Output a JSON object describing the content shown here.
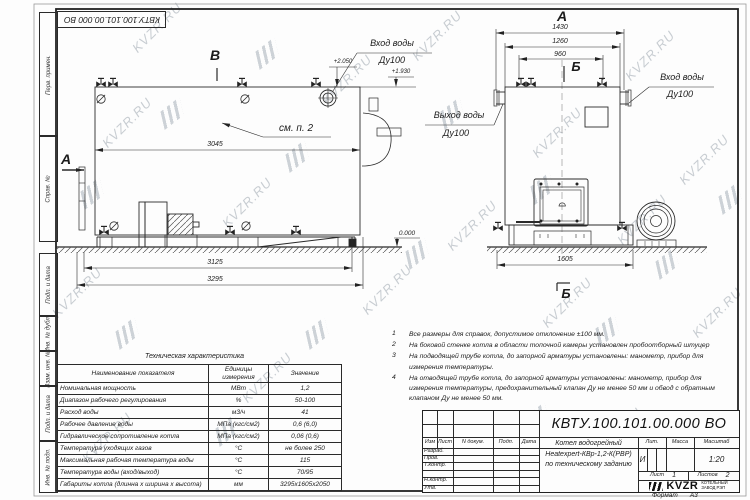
{
  "watermark": {
    "text": "KVZR.RU"
  },
  "stamp_top": "КВТУ.100.101.00.000 ВО",
  "margin": {
    "labels": [
      "Перв. примен.",
      "Справ. №",
      "Подп. и дата",
      "Инв. № дубл.",
      "Взам. инв. №",
      "Подп. и дата",
      "Инв. № подл."
    ]
  },
  "drawing": {
    "view_side": {
      "label": "В",
      "section": "А",
      "callout": "см. п. 2",
      "dim_body": "3045",
      "dim_frame": "3125",
      "dim_total": "3295",
      "level_top": "+2.050",
      "level_pipe": "+1.930",
      "inlet_l1": "Вход воды",
      "inlet_l2": "Ду100"
    },
    "view_front": {
      "label": "А",
      "section_top": "Б",
      "section_bottom": "Б",
      "dim_flanges": "1430",
      "dim_body": "1260",
      "dim_valves": "960",
      "dim_base": "1605",
      "level_zero": "0.000",
      "outlet_l1": "Выход воды",
      "outlet_l2": "Ду100",
      "inlet_l1": "Вход воды",
      "inlet_l2": "Ду100"
    }
  },
  "tech_table": {
    "title": "Техническая характеристика",
    "headers": {
      "name": "Наименование показателя",
      "unit": "Единицы измерения",
      "value": "Значение"
    },
    "rows": [
      {
        "name": "Номинальная мощность",
        "unit": "МВт",
        "value": "1,2"
      },
      {
        "name": "Диапазон рабочего регулирования",
        "unit": "%",
        "value": "50-100"
      },
      {
        "name": "Расход воды",
        "unit": "м3/ч",
        "value": "41"
      },
      {
        "name": "Рабочее давление воды",
        "unit": "МПа (кгс/см2)",
        "value": "0,6 (6,0)"
      },
      {
        "name": "Гидравлическое сопротивление котла",
        "unit": "МПа (кгс/см2)",
        "value": "0,06 (0,6)"
      },
      {
        "name": "Температура уходящих газов",
        "unit": "°С",
        "value": "не более 250"
      },
      {
        "name": "Максимальная рабочая температура воды",
        "unit": "°С",
        "value": "115"
      },
      {
        "name": "Температура воды (вход/выход)",
        "unit": "°С",
        "value": "70/95"
      },
      {
        "name": "Габариты котла (длинна х ширина х высота)",
        "unit": "мм",
        "value": "3295х1605х2050"
      }
    ]
  },
  "notes": {
    "items": [
      {
        "num": "1",
        "text": "Все размеры для справок, допустимое отклонение ±100 мм."
      },
      {
        "num": "2",
        "text": "На боковой стенке котла в области топочной камеры установлен пробоотборный штуцер"
      },
      {
        "num": "3",
        "text": "На подводящей трубе котла, до запорной арматуры установлены: манометр, прибор для измерения температуры."
      },
      {
        "num": "4",
        "text": "На отводящей трубе котла, до запорной арматуры установлены: манометр, прибор для измерения температуры, предохранительный клапан Ду не менее 50 мм и обвод с обратным клапаном Ду не менее 50 мм."
      }
    ]
  },
  "title_block": {
    "designation": "КВТУ.100.101.00.000  ВО",
    "product_line1": "Котел водогрейный",
    "product_line2": "Heatexpert-КВр-1,2-К(РВР)",
    "product_line3": "по техническому заданию",
    "cols": {
      "izm": "Изм",
      "list": "Лист",
      "doc": "N докум.",
      "podp": "Подп.",
      "data": "Дата"
    },
    "rows": [
      "Разраб.",
      "Пров.",
      "Т.контр.",
      "",
      "Н.контр.",
      "Утв."
    ],
    "lit_h": "Лит.",
    "lit": "И",
    "mass_h": "Масса",
    "scale_h": "Масштаб",
    "scale": "1:20",
    "sheet_h": "Лист",
    "sheet": "1",
    "sheets_h": "Листов",
    "sheets": "2",
    "logo": "KVZR",
    "company_l1": "КОТЕЛЬНЫЙ",
    "company_l2": "ЗАВОД РЭП",
    "format_label": "Формат",
    "format": "А3"
  }
}
